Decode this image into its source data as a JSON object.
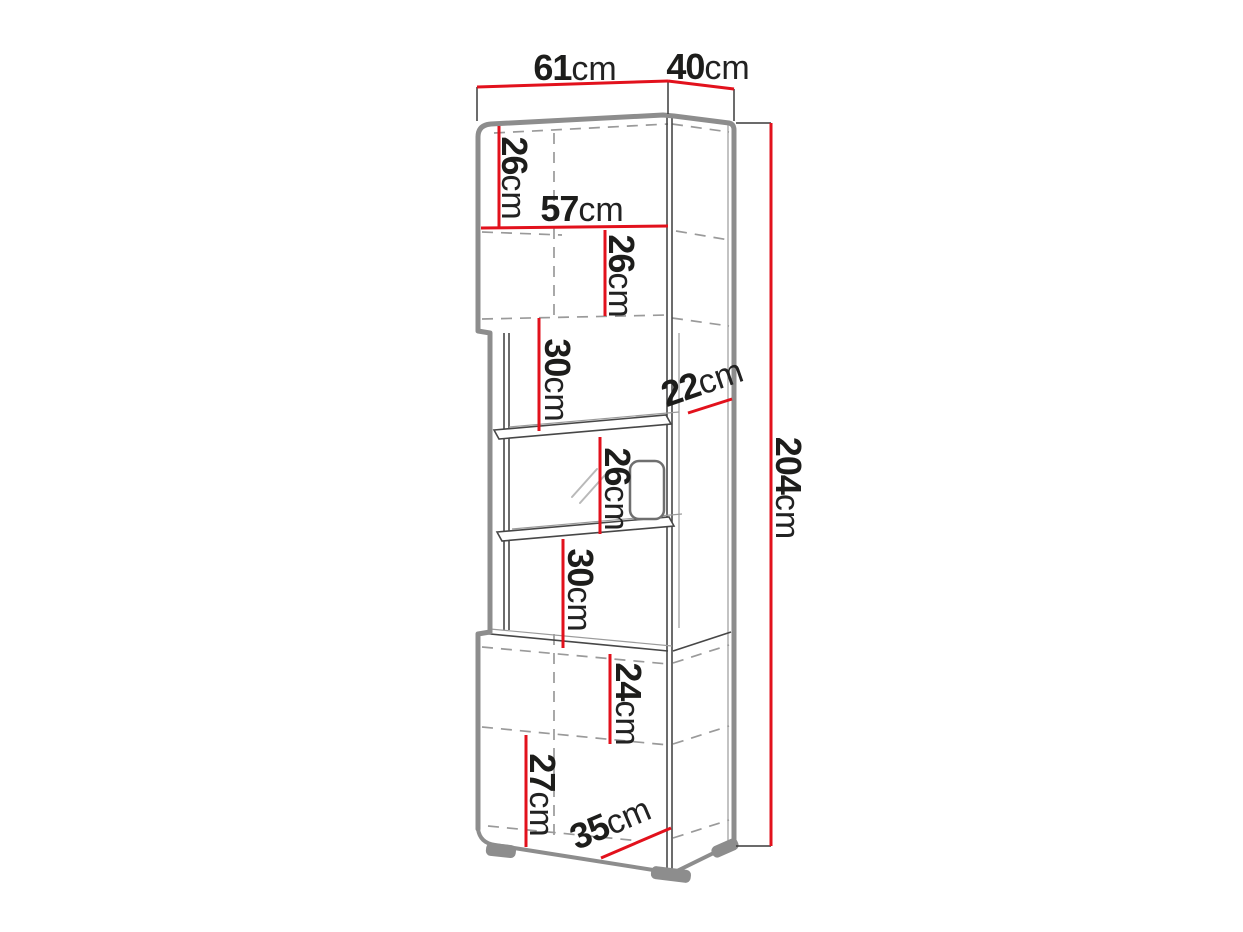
{
  "diagram": {
    "subject": "tall display cabinet dimension drawing",
    "unit": "cm",
    "colors": {
      "dimension_line": "#e2111c",
      "cabinet_outline": "#8d8d8d",
      "interior_line": "#474747",
      "dashed_line": "#9a9a9a",
      "label_text": "#1d1d1b",
      "background": "#ffffff"
    },
    "dimensions": {
      "top_width": {
        "value": "61",
        "unit": "cm"
      },
      "top_depth": {
        "value": "40",
        "unit": "cm"
      },
      "upper_door_height": {
        "value": "26",
        "unit": "cm"
      },
      "upper_inner_width": {
        "value": "57",
        "unit": "cm"
      },
      "upper_lower_height": {
        "value": "26",
        "unit": "cm"
      },
      "gap_above_shelf": {
        "value": "30",
        "unit": "cm"
      },
      "middle_depth": {
        "value": "22",
        "unit": "cm"
      },
      "between_shelves": {
        "value": "26",
        "unit": "cm"
      },
      "gap_below_shelf": {
        "value": "30",
        "unit": "cm"
      },
      "total_height": {
        "value": "204",
        "unit": "cm"
      },
      "lower_inner_height": {
        "value": "24",
        "unit": "cm"
      },
      "lower_door_height": {
        "value": "27",
        "unit": "cm"
      },
      "base_depth": {
        "value": "35",
        "unit": "cm"
      }
    }
  }
}
